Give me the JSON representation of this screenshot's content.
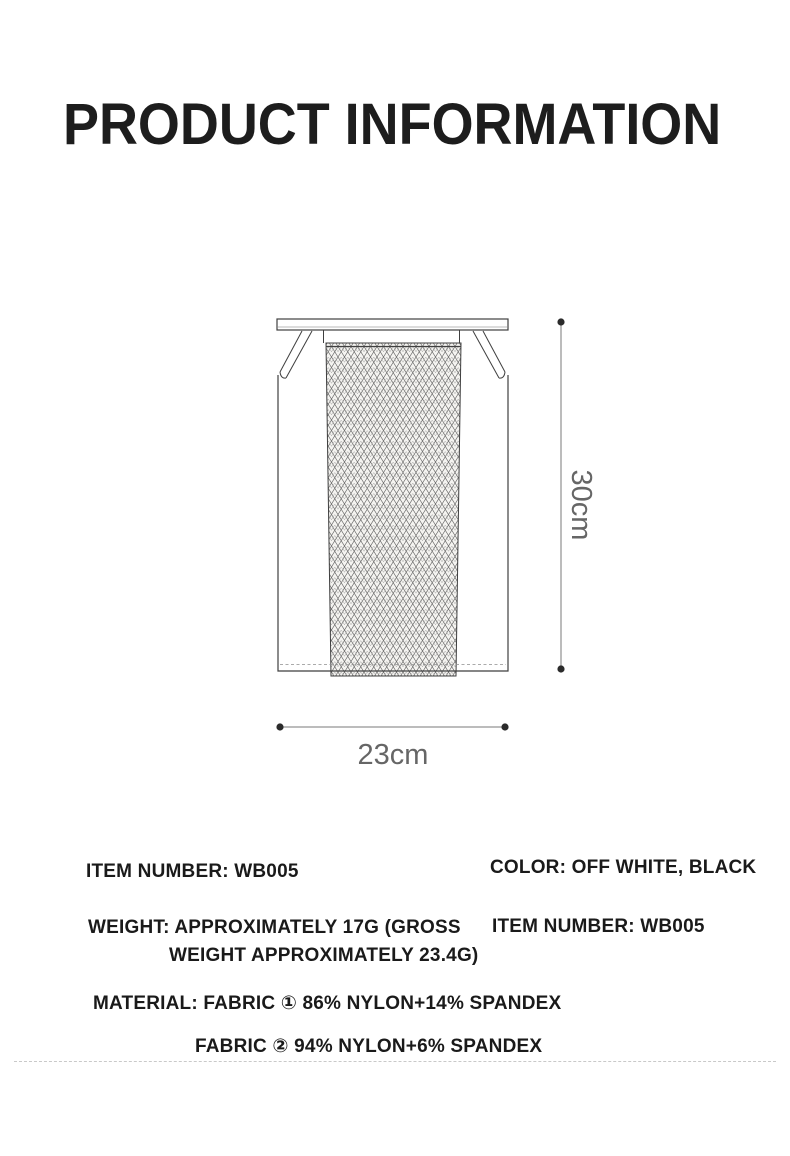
{
  "title": "PRODUCT INFORMATION",
  "diagram": {
    "height_label": "30cm",
    "width_label": "23cm"
  },
  "specs": {
    "item_number_left": "ITEM NUMBER: WB005",
    "color": "COLOR: OFF WHITE, BLACK",
    "weight_line1": "WEIGHT: APPROXIMATELY 17G (GROSS",
    "weight_line2": "WEIGHT APPROXIMATELY 23.4G)",
    "item_number_right": "ITEM NUMBER: WB005",
    "material_line1": "MATERIAL: FABRIC ① 86% NYLON+14% SPANDEX",
    "material_line2": "FABRIC ② 94% NYLON+6% SPANDEX"
  },
  "colors": {
    "text_primary": "#1d1d1d",
    "dimension_text": "#666666",
    "drawing_line": "#3f3f3f",
    "dimension_dot": "#2b2b2b",
    "dashed_divider": "#c9c9c9"
  }
}
